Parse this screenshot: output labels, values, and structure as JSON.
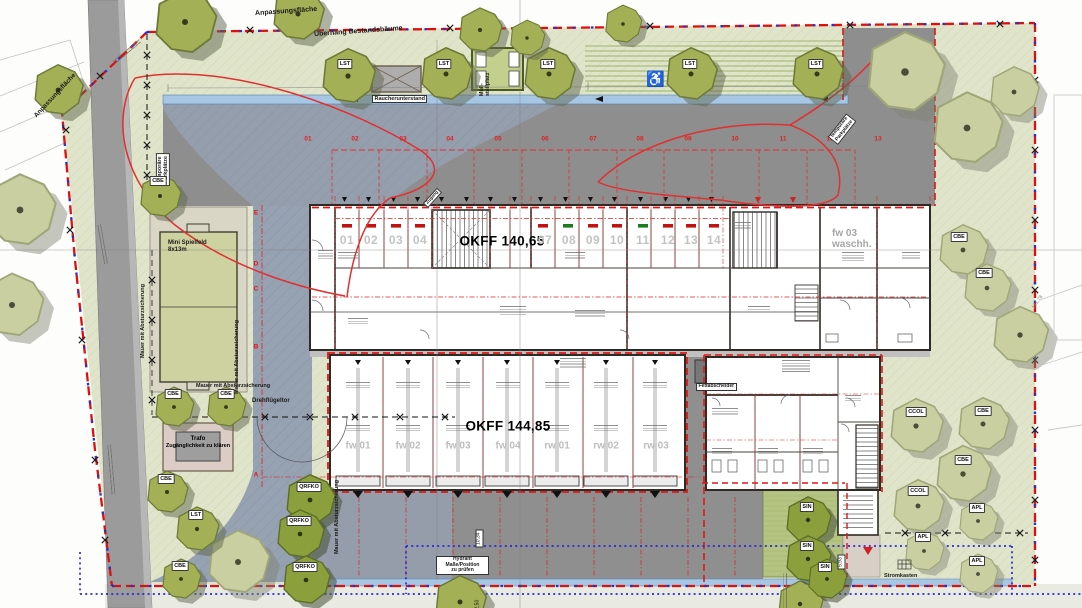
{
  "buildings": {
    "garage": {
      "okff": "OKFF 140,65",
      "bays": [
        "01",
        "02",
        "03",
        "04",
        "07",
        "08",
        "09",
        "10",
        "11",
        "12",
        "13",
        "14"
      ]
    },
    "hall": {
      "okff": "OKFF 144,85",
      "bays": [
        "fw 01",
        "fw 02",
        "fw 03",
        "fw 04",
        "rw 01",
        "rw 02",
        "rw 03"
      ]
    },
    "wash": {
      "line1": "fw 03",
      "line2": "waschh."
    }
  },
  "labels": {
    "anpassungsflaeche": "Anpassungsfläche",
    "ueberhang": "Überhang Bestandsbäume",
    "temp1": "temporäre",
    "temp2": "Parkplätze",
    "raucherunterstand": "Raucherunterstand",
    "muell1": "Müll-",
    "muell2": "stellplatz",
    "spielfeld1": "Mini Spielfeld",
    "spielfeld2": "8x13m",
    "mauer": "Mauer mit Absturzsicherung",
    "drehfluegeltor": "Drehflügeltor",
    "trafo1": "Trafo",
    "trafo2": "Zugänglichkeit zu klären",
    "fettabscheider": "Fettabscheider",
    "hyd1": "Hydrant",
    "hyd2": "Maße/Position",
    "hyd3": "zu prüfen",
    "stromkasten": "Stromkasten",
    "zugang": "Zugang"
  },
  "parking": {
    "stalls": [
      "01",
      "02",
      "03",
      "04",
      "05",
      "06",
      "07",
      "08",
      "09",
      "10",
      "11",
      "12",
      "13"
    ]
  },
  "grid": {
    "letters": [
      "E",
      "D",
      "C",
      "B",
      "A"
    ]
  },
  "trees": {
    "CBE": "CBE",
    "LST": "LST",
    "QRFKO": "QRFKO",
    "CCOL": "CCOL",
    "APL": "APL",
    "SIN": "SIN"
  },
  "dims": {
    "d1": "10,34",
    "d2": "2,50",
    "d3": "5,93",
    "elev": "141,78"
  },
  "icons": {
    "accessible": "♿"
  },
  "colors": {
    "boundary_red": "#dd1010",
    "boundary_blue": "#2233cc",
    "site_green": "#e0e4ca",
    "asphalt": "#8e8e8e",
    "driveway": "#96a1b1",
    "channel_blue": "#a6c6e4"
  }
}
